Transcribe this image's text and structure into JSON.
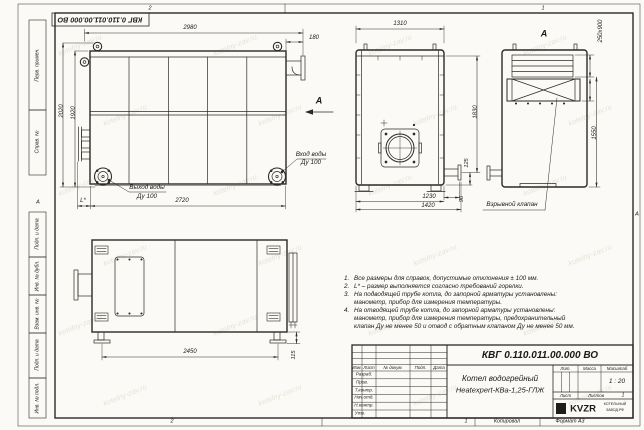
{
  "sheet": {
    "stamp_inverted": "КВГ 0.110.011.00.000 ВО",
    "watermark": "kotelny-zav.ru",
    "zones": {
      "top_left": "2",
      "top_right": "1",
      "bottom_left": "2",
      "bottom_right": "1",
      "side_left": "А",
      "side_right": "А"
    }
  },
  "margin_labels": {
    "c0": "Перв. примен.",
    "c1": "Справ. №",
    "c2": "Подп. и дата",
    "c3": "Инв. № дубл.",
    "c4": "Взам. инв. №",
    "c5": "Подп. и дата",
    "c6": "Инв. № подл."
  },
  "front_view": {
    "dim_width": "2980",
    "dim_offset": "180",
    "dim_h_outer": "2020",
    "dim_h_inner": "1920",
    "dim_bottom": "2720",
    "dim_l": "L*",
    "view_label": "А",
    "outlet_label": "Выход воды",
    "outlet_dn": "Ду 100",
    "inlet_label": "Вход воды",
    "inlet_dn": "Ду 100"
  },
  "side_view": {
    "dim_width": "1310",
    "dim_height": "1830",
    "dim_off1": "125",
    "dim_off2": "90",
    "dim_depth": "1230",
    "dim_overall": "1420"
  },
  "rear_view": {
    "view_label": "А",
    "dim_slot": "250x900",
    "dim_height": "1550",
    "callout": "Взрывной клапан"
  },
  "plan_view": {
    "dim_width": "2450",
    "dim_height": "115"
  },
  "notes": {
    "items": [
      {
        "num": "1.",
        "text": "Все размеры для справок, допустимые отклонения ± 100 мм."
      },
      {
        "num": "2.",
        "text": "L* – размер выполняется согласно требований горелки."
      },
      {
        "num": "3.",
        "text": "На подводящей трубе котла, до запорной арматуры установлены: манометр, прибор для измерения температуры."
      },
      {
        "num": "4.",
        "text": "На отводящей трубе котла, до запорной арматуры установлены: манометр, прибор для измерения температуры, предохранительный клапан Ду не менее 50 и отвод с обратным клапаном Ду не менее 50 мм."
      }
    ]
  },
  "title_block": {
    "doc_number": "КВГ 0.110.011.00.000 ВО",
    "columns": {
      "izm": "Изм.",
      "list": "Лист",
      "doc": "№ докум.",
      "podp": "Подп.",
      "date": "Дата"
    },
    "rows": {
      "r0": "Разраб.",
      "r1": "Пров.",
      "r2": "Т.контр.",
      "r3": "Нач.отд.",
      "r4": "Н.контр.",
      "r5": "Утв."
    },
    "name_line1": "Котел водогрейный",
    "name_line2": "Heatexpert-КВа-1,25-ГЛЖ",
    "lit_label": "Лит.",
    "mass_label": "Масса",
    "scale_label": "Масштаб",
    "scale_value": "1 : 20",
    "sheet_label": "Лист",
    "sheets_label": "Листов",
    "sheets_value": "1",
    "logo_text": "KVZR",
    "logo_sub1": "КОТЕЛЬНЫЙ",
    "logo_sub2": "ЗАВОД.РФ",
    "copied_label": "Копировал",
    "format_label": "Формат А3"
  }
}
